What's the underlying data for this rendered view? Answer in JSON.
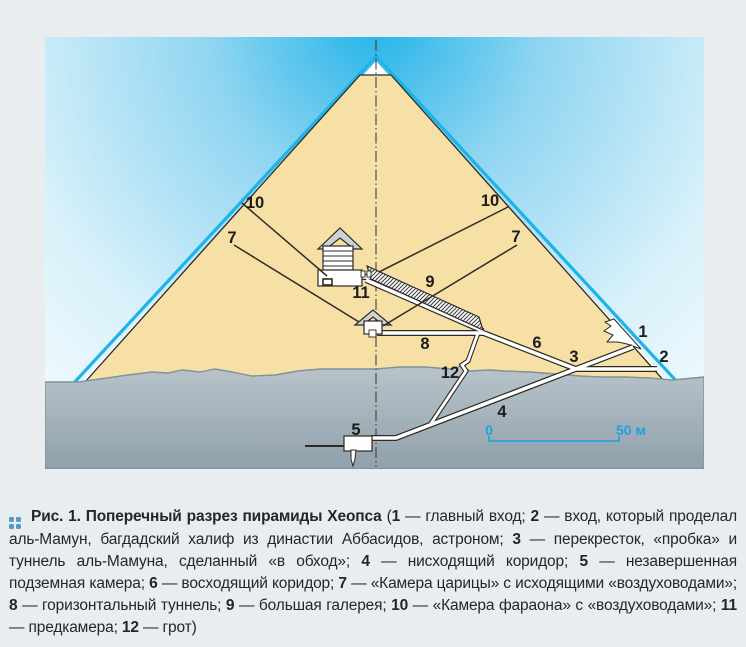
{
  "colors": {
    "page_bg": "#e9edf0",
    "sand": "#f6e0a5",
    "outline": "#2e2a25",
    "face_blue": "#1cb4e9",
    "sky_deep": "#25b4e9",
    "sky_mid": "#8fd5f1",
    "sky_light": "#f3fbfe",
    "ground_top": "#b9c4ca",
    "ground_bottom": "#8fa0ab",
    "ground_line": "#7e939b",
    "scale_blue": "#1aa3e0",
    "label_ink": "#1c1c1c",
    "marker_blue": "#4f9ccb",
    "roof_gray": "#cdd2d6"
  },
  "figure": {
    "diagram": {
      "description": "Поперечный разрез пирамиды Хеопса",
      "labels": [
        {
          "id": "label-1",
          "text": "1",
          "x": 643,
          "y": 332
        },
        {
          "id": "label-2",
          "text": "2",
          "x": 664,
          "y": 357
        },
        {
          "id": "label-3",
          "text": "3",
          "x": 574,
          "y": 357
        },
        {
          "id": "label-4",
          "text": "4",
          "x": 502,
          "y": 412
        },
        {
          "id": "label-5",
          "text": "5",
          "x": 356,
          "y": 430
        },
        {
          "id": "label-6",
          "text": "6",
          "x": 537,
          "y": 343
        },
        {
          "id": "label-7-left",
          "text": "7",
          "x": 232,
          "y": 238
        },
        {
          "id": "label-7-right",
          "text": "7",
          "x": 516,
          "y": 237
        },
        {
          "id": "label-8",
          "text": "8",
          "x": 425,
          "y": 344
        },
        {
          "id": "label-9",
          "text": "9",
          "x": 430,
          "y": 282
        },
        {
          "id": "label-10-left",
          "text": "10",
          "x": 255,
          "y": 203
        },
        {
          "id": "label-10-right",
          "text": "10",
          "x": 490,
          "y": 201
        },
        {
          "id": "label-11",
          "text": "11",
          "x": 361,
          "y": 293
        },
        {
          "id": "label-12",
          "text": "12",
          "x": 450,
          "y": 373
        },
        {
          "id": "scale-zero",
          "text": "0",
          "x": 489,
          "y": 430,
          "blue": true
        },
        {
          "id": "scale-fifty",
          "text": "50 м",
          "x": 616,
          "y": 430,
          "blue": true,
          "anchor": "start"
        }
      ]
    },
    "caption": {
      "segments": [
        {
          "b": "Рис. 1. Поперечный разрез пирамиды Хеопса "
        },
        {
          "t": "("
        },
        {
          "b": "1"
        },
        {
          "t": " — главный вход; "
        },
        {
          "b": "2"
        },
        {
          "t": " — вход, который проделал аль-Мамун, багдадский халиф из династии Аббасидов, астроном; "
        },
        {
          "b": "3"
        },
        {
          "t": " — перекресток, «пробка» и туннель аль-Мамуна, сделанный «в обход»; "
        },
        {
          "b": "4"
        },
        {
          "t": " — нисходящий коридор; "
        },
        {
          "b": "5"
        },
        {
          "t": " — незавершенная подземная камера; "
        },
        {
          "b": "6"
        },
        {
          "t": " — восходящий коридор; "
        },
        {
          "b": "7"
        },
        {
          "t": " — «Камера царицы» с исходящими «воздуховодами»; "
        },
        {
          "b": "8"
        },
        {
          "t": " — горизонтальный туннель; "
        },
        {
          "b": "9"
        },
        {
          "t": " — большая галерея; "
        },
        {
          "b": "10"
        },
        {
          "t": " — «Камера фараона» с «воздуховодами»; "
        },
        {
          "b": "11"
        },
        {
          "t": " — предкамера; "
        },
        {
          "b": "12"
        },
        {
          "t": " — грот)"
        }
      ]
    }
  }
}
